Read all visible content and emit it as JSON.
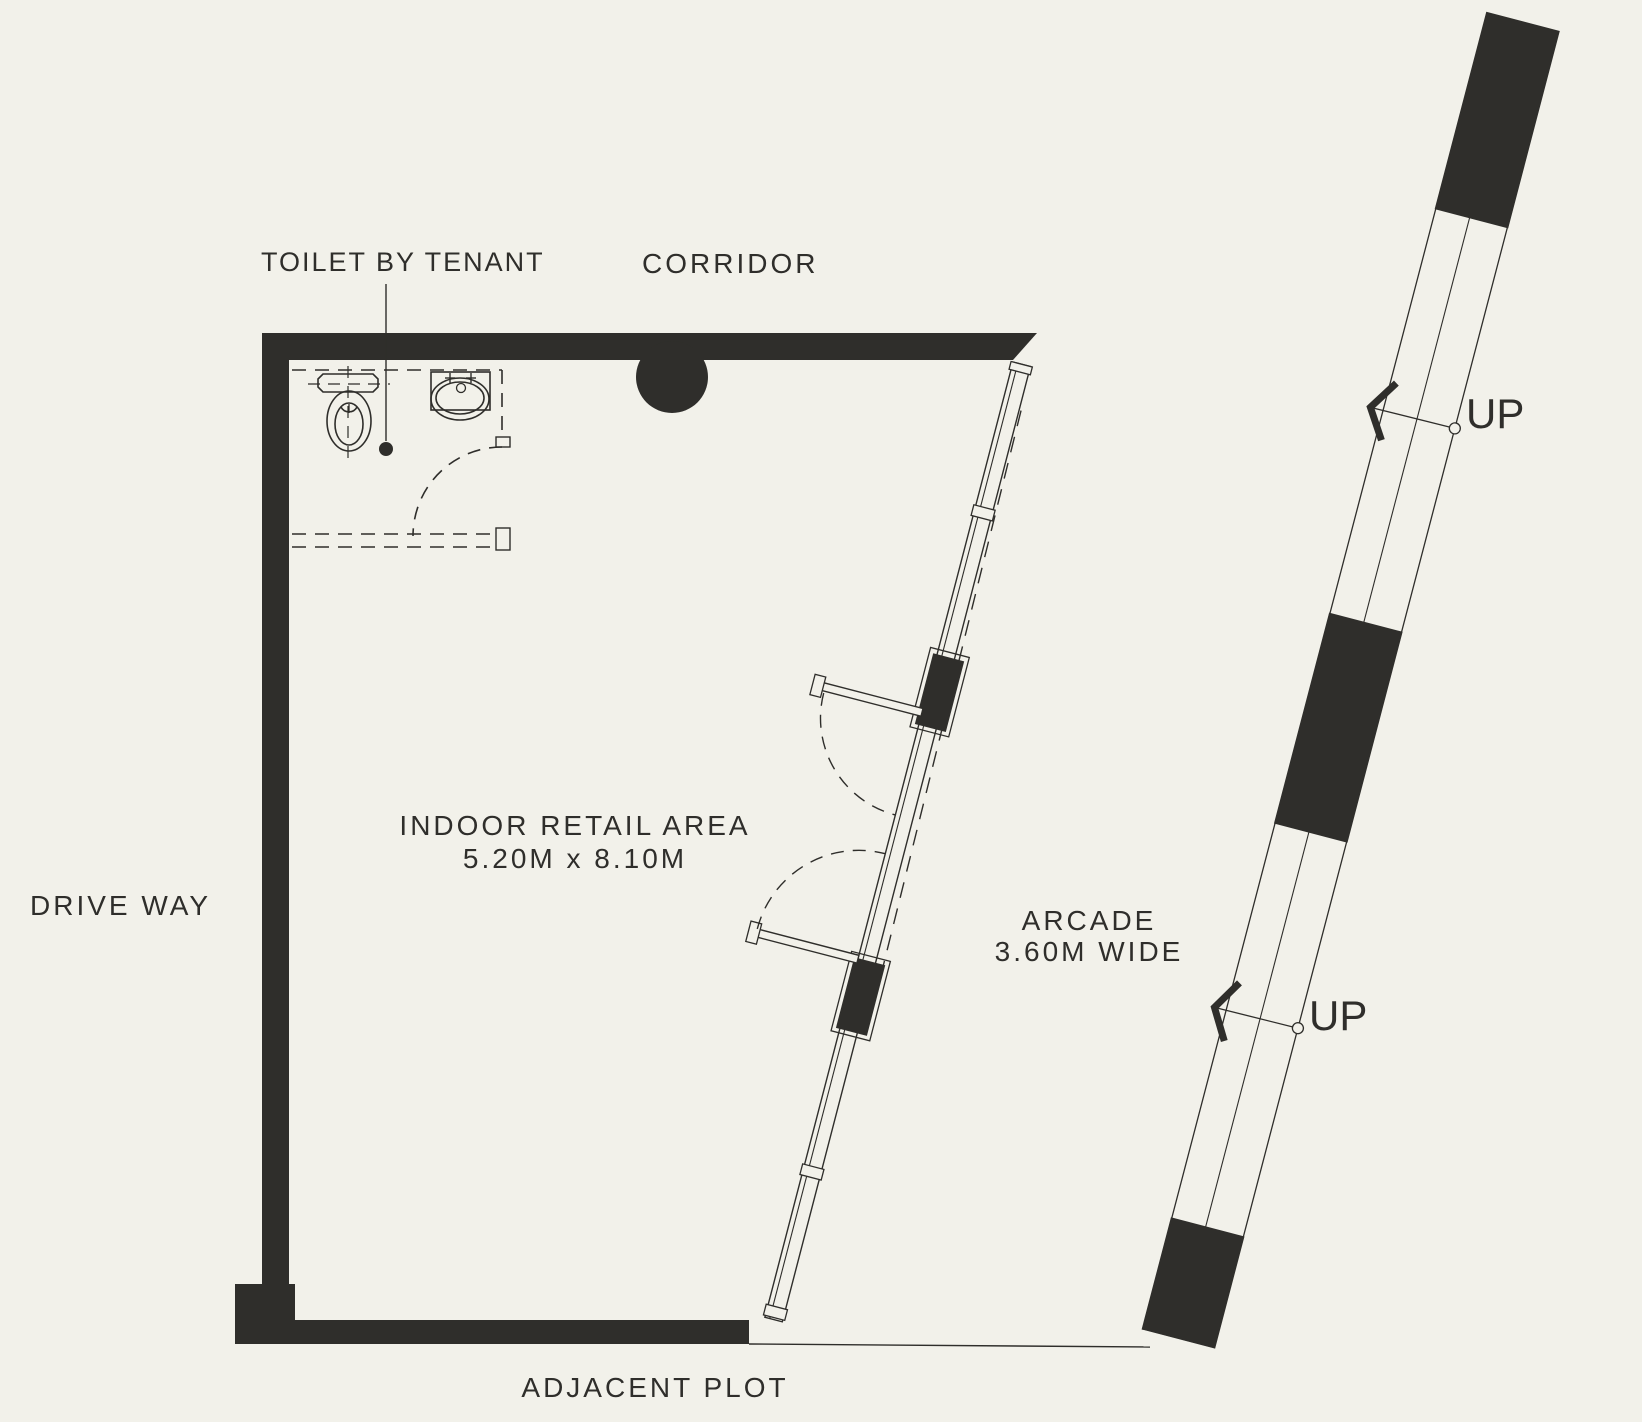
{
  "plan": {
    "colors": {
      "background": "#f2f1ea",
      "ink": "#2f2e2b"
    },
    "labels": {
      "toilet": "TOILET BY TENANT",
      "corridor": "CORRIDOR",
      "retail_title": "INDOOR RETAIL AREA",
      "retail_dims": "5.20M x 8.10M",
      "drive_way": "DRIVE WAY",
      "arcade_title": "ARCADE",
      "arcade_dims": "3.60M WIDE",
      "adjacent_plot": "ADJACENT PLOT",
      "up_marker_1": "UP",
      "up_marker_2": "UP"
    }
  }
}
